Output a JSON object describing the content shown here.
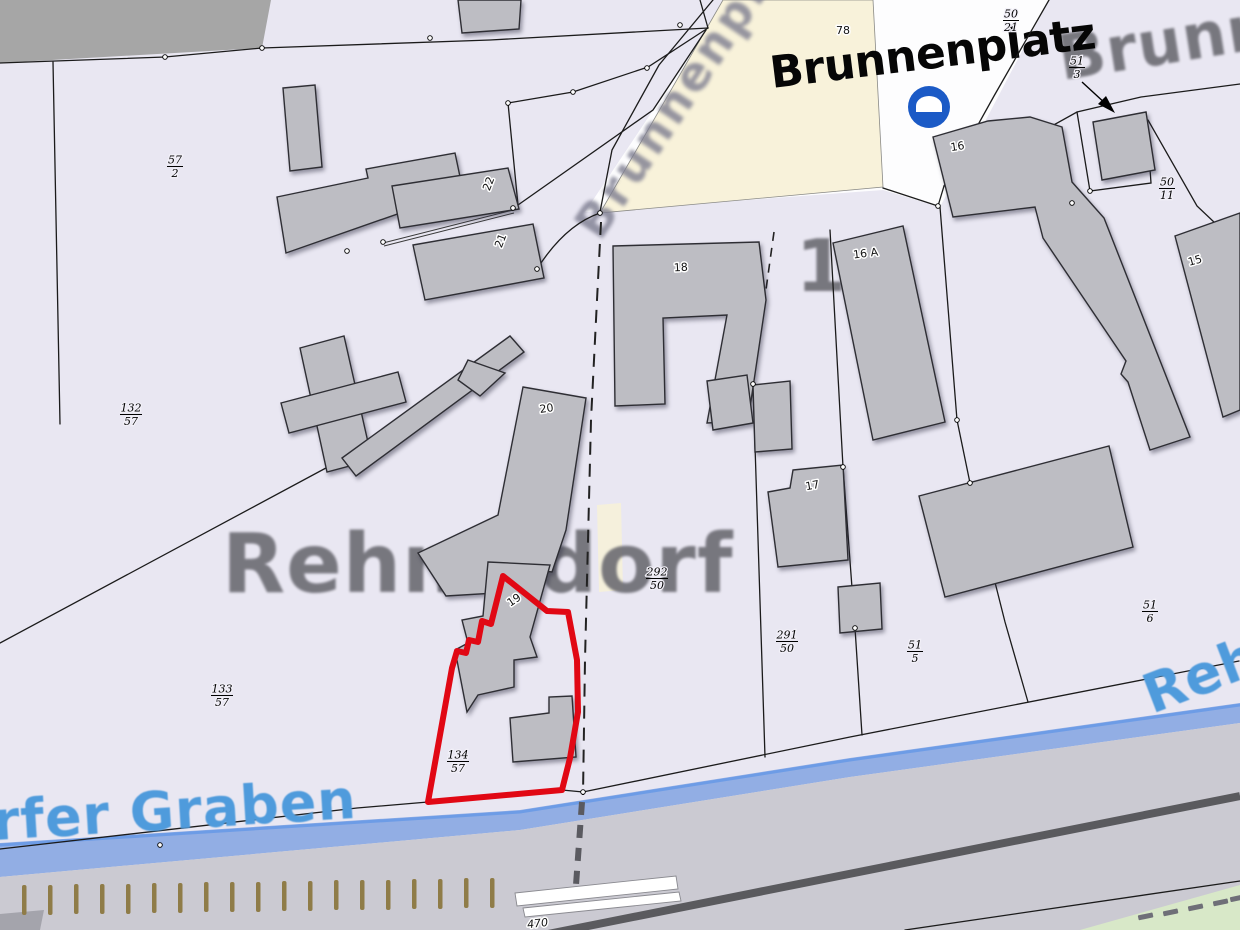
{
  "map": {
    "labels": {
      "brunnenplatz_bold": "Brunnenplatz",
      "brunnenplatz_diagonal": "Brunnenpl",
      "brunnen_top_right": "Brunnen",
      "place_rehmsdorf": "Rehmsdorf",
      "stream_graben": "rfer Graben",
      "stream_reh": "Reh",
      "ghost_digit": "1"
    },
    "house_numbers": {
      "h78": "78",
      "h16": "16",
      "h16a": "16 A",
      "h18": "18",
      "h15": "15",
      "h17": "17",
      "h20": "20",
      "h19": "19",
      "h21": "21",
      "h22": "22",
      "h470": "470"
    },
    "fractions": {
      "f57_2": {
        "num": "57",
        "den": "2"
      },
      "f132_57": {
        "num": "132",
        "den": "57"
      },
      "f133_57": {
        "num": "133",
        "den": "57"
      },
      "f134_57": {
        "num": "134",
        "den": "57"
      },
      "f292_50": {
        "num": "292",
        "den": "50"
      },
      "f291_50": {
        "num": "291",
        "den": "50"
      },
      "f51_5": {
        "num": "51",
        "den": "5"
      },
      "f51_6": {
        "num": "51",
        "den": "6"
      },
      "f50_21": {
        "num": "50",
        "den": "21"
      },
      "f51_3": {
        "num": "51",
        "den": "3"
      },
      "f50_11": {
        "num": "50",
        "den": "11"
      }
    },
    "icons": {
      "no_entry_sign": "no-entry-sign"
    },
    "colors": {
      "background": "#e9e7f2",
      "parcel_highlight": "#e10814",
      "water": "#92aee4",
      "water_edge": "#6d9ce6",
      "square": "#f8f2da",
      "building": "#bdbdc3",
      "building_outline": "#2e2e34",
      "road_top": "#a6a6a6",
      "road_band": "#cbcad2",
      "water_label": "#4f9bdc",
      "green_verge": "#d8e8c8",
      "tick_brown": "#8f7c48",
      "sign_blue": "#1b5ac6"
    }
  }
}
